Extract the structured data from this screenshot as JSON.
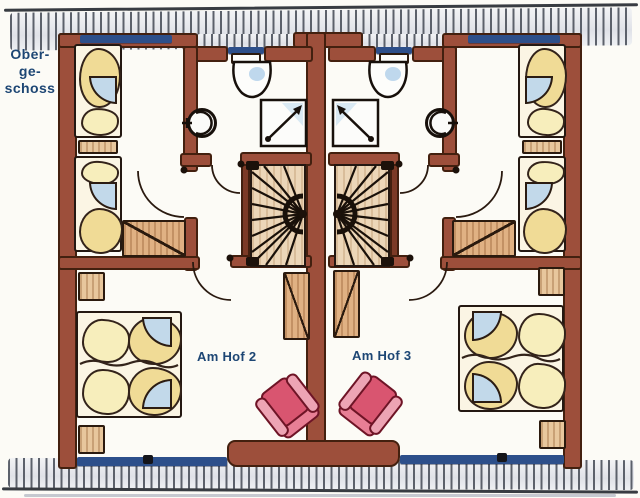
{
  "floor_label": {
    "line1": "Ober-",
    "line2": "ge-",
    "line3": "schoss",
    "full": "Obergeschoss"
  },
  "units": [
    {
      "name_label": "Am Hof 2"
    },
    {
      "name_label": "Am Hof 3"
    }
  ],
  "palette": {
    "wall_brown": "#9d4f3b",
    "wall_outline": "#43200f",
    "window_blue": "#2d4f8a",
    "label_blue": "#1d4674",
    "bedding_yellow": "#f0db96",
    "pillow_cream": "#f7eebc",
    "wood_tan": "#e0b183",
    "stair_tan": "#ecd6b8",
    "blanket_blue": "#c2d9ea",
    "armchair_pink": "#d95570",
    "roof_hatch_gray": "#e9ebee",
    "hatch_line_gray": "#5c616b"
  },
  "fixtures_icons": [
    "roof-hatching-icon",
    "window-icon",
    "door-swing-icon",
    "spiral-staircase-icon",
    "toilet-icon",
    "washbasin-icon",
    "shower-icon",
    "single-bed-icon",
    "double-bed-icon",
    "wardrobe-icon",
    "nightstand-icon",
    "armchair-icon"
  ]
}
